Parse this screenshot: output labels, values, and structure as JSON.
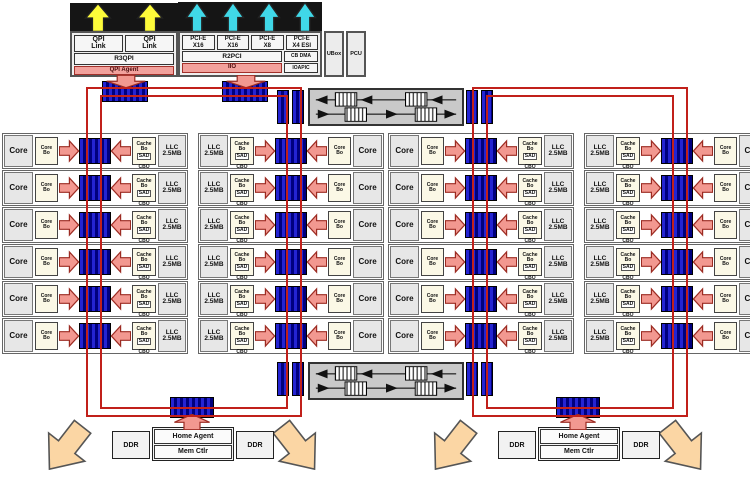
{
  "colors": {
    "ring": "#c1201a",
    "stop_a": "#2424d2",
    "stop_b": "#00007e",
    "arrow_fill": "#f29890",
    "arrow_stroke": "#9c2b22",
    "yellow": "#fdfb3a",
    "cyan": "#40d8e8",
    "orange": "#fbd6a4",
    "tile_bg": "#e7e7e7",
    "box_bg": "#efefef",
    "cream": "#fbf8e6",
    "agent_strip": "#f2a19c",
    "switch_bg": "#c9c9c9"
  },
  "top": {
    "qpi": {
      "link_lines": [
        "QPI",
        "Link"
      ],
      "bridge": "R3QPI",
      "agent": "QPI Agent"
    },
    "pcie": {
      "ports": [
        [
          "PCI-E",
          "X16"
        ],
        [
          "PCI-E",
          "X16"
        ],
        [
          "PCI-E",
          "X8"
        ],
        [
          "PCI-E",
          "X4 ESI"
        ]
      ],
      "dma": "CB DMA",
      "ioapic": "IOAPIC",
      "bridge": "R2PCI",
      "agent": "IIO"
    },
    "ubox": "UBox",
    "pcu": "PCU"
  },
  "tile": {
    "core": "Core",
    "bo_lines": [
      "Core",
      "Bo"
    ],
    "cache_lines": [
      "Cache",
      "Bo"
    ],
    "sad": "SAD",
    "cbo": "CBO",
    "llc_lines": [
      "LLC",
      "2.5MB"
    ]
  },
  "grid": {
    "rows": 6,
    "columns": [
      {
        "mirrored": false
      },
      {
        "mirrored": true
      },
      {
        "mirrored": false
      },
      {
        "mirrored": true
      }
    ]
  },
  "bottom": {
    "units": [
      {
        "ddr_left": "DDR",
        "home_agent": "Home Agent",
        "mem_ctlr": "Mem Ctlr",
        "ddr_right": "DDR"
      },
      {
        "ddr_left": "DDR",
        "home_agent": "Home Agent",
        "mem_ctlr": "Mem Ctlr",
        "ddr_right": "DDR"
      }
    ]
  }
}
